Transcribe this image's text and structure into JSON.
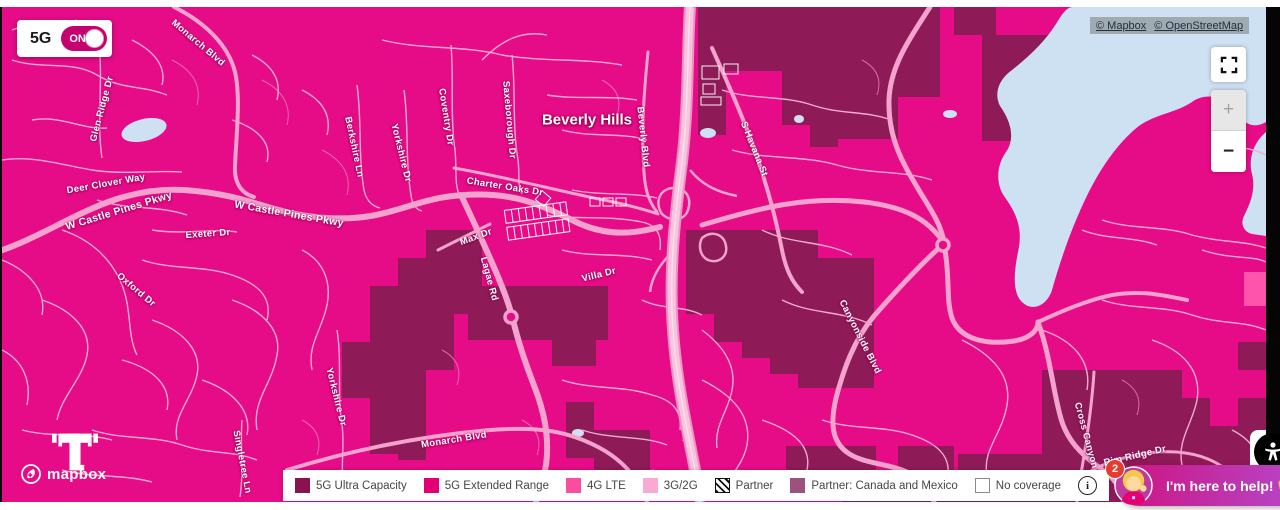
{
  "toggle": {
    "label": "5G",
    "state": "ON"
  },
  "attribution": {
    "links": [
      {
        "label": "© Mapbox"
      },
      {
        "label": "© OpenStreetMap"
      }
    ]
  },
  "controls": {
    "zoom_in": "+",
    "zoom_out": "−"
  },
  "map": {
    "place_label": "Beverly Hills",
    "colors": {
      "base": "#E60B87",
      "ultra_capacity": "#8E1A57",
      "lte_patch": "#FF54AC",
      "road_major": "#F4A3CE",
      "road_highway": "#F9C4E0",
      "lake": "#CEE1F2"
    },
    "street_labels": [
      {
        "text": "Monarch Blvd",
        "x": 196,
        "y": 36,
        "rot": 40
      },
      {
        "text": "Glen Ridge Dr",
        "x": 100,
        "y": 102,
        "rot": -75
      },
      {
        "text": "Deer Clover Way",
        "x": 104,
        "y": 177,
        "rot": -10
      },
      {
        "text": "W Castle Pines Pkwy",
        "x": 117,
        "y": 204,
        "rot": -17,
        "size": 10.5
      },
      {
        "text": "W Castle Pines Pkwy",
        "x": 287,
        "y": 207,
        "rot": 10,
        "size": 10.5
      },
      {
        "text": "Exeter Dr",
        "x": 206,
        "y": 227,
        "rot": -4
      },
      {
        "text": "Oxford Dr",
        "x": 134,
        "y": 283,
        "rot": 40
      },
      {
        "text": "Berkshire Ln",
        "x": 352,
        "y": 140,
        "rot": 78
      },
      {
        "text": "Yorkshire Dr",
        "x": 399,
        "y": 146,
        "rot": 76
      },
      {
        "text": "Coventry Dr",
        "x": 444,
        "y": 110,
        "rot": 81
      },
      {
        "text": "Saxeborough Dr",
        "x": 507,
        "y": 113,
        "rot": 85
      },
      {
        "text": "Charter Oaks Dr",
        "x": 503,
        "y": 180,
        "rot": 9
      },
      {
        "text": "Beverly Blvd",
        "x": 641,
        "y": 130,
        "rot": 84
      },
      {
        "text": "S Havana St",
        "x": 752,
        "y": 142,
        "rot": 68
      },
      {
        "text": "Max Dr",
        "x": 474,
        "y": 230,
        "rot": -20
      },
      {
        "text": "Lagae Rd",
        "x": 487,
        "y": 272,
        "rot": 75
      },
      {
        "text": "Villa Dr",
        "x": 597,
        "y": 268,
        "rot": -14
      },
      {
        "text": "Monarch Blvd",
        "x": 452,
        "y": 433,
        "rot": -9
      },
      {
        "text": "Yorkshire Dr",
        "x": 334,
        "y": 390,
        "rot": 76
      },
      {
        "text": "Singletree Ln",
        "x": 240,
        "y": 455,
        "rot": 79
      },
      {
        "text": "Canyonside Blvd",
        "x": 858,
        "y": 330,
        "rot": 63
      },
      {
        "text": "Cross Canyon Trail",
        "x": 1087,
        "y": 440,
        "rot": 75
      },
      {
        "text": "Rim Ridge Dr",
        "x": 1133,
        "y": 449,
        "rot": -13
      },
      {
        "text": "Golden",
        "x": 998,
        "y": 478,
        "rot": 45
      }
    ]
  },
  "legend": {
    "items": [
      {
        "label": "5G Ultra Capacity",
        "type": "solid",
        "swatch": "#8A134E"
      },
      {
        "label": "5G Extended Range",
        "type": "solid",
        "swatch": "#E20074"
      },
      {
        "label": "4G LTE",
        "type": "solid",
        "swatch": "#FA4D9F"
      },
      {
        "label": "3G/2G",
        "type": "solid",
        "swatch": "#F9A9D4"
      },
      {
        "label": "Partner",
        "type": "hatch",
        "swatch": "#111111"
      },
      {
        "label": "Partner: Canada and Mexico",
        "type": "solid",
        "swatch": "#9C527E"
      },
      {
        "label": "No coverage",
        "type": "empty",
        "swatch": "#FFFFFF"
      }
    ],
    "info_glyph": "i"
  },
  "logos": {
    "map_provider": "mapbox"
  },
  "chat": {
    "badge": "2",
    "message": "I'm here to help!",
    "emoji_icon": "raising-hands"
  }
}
